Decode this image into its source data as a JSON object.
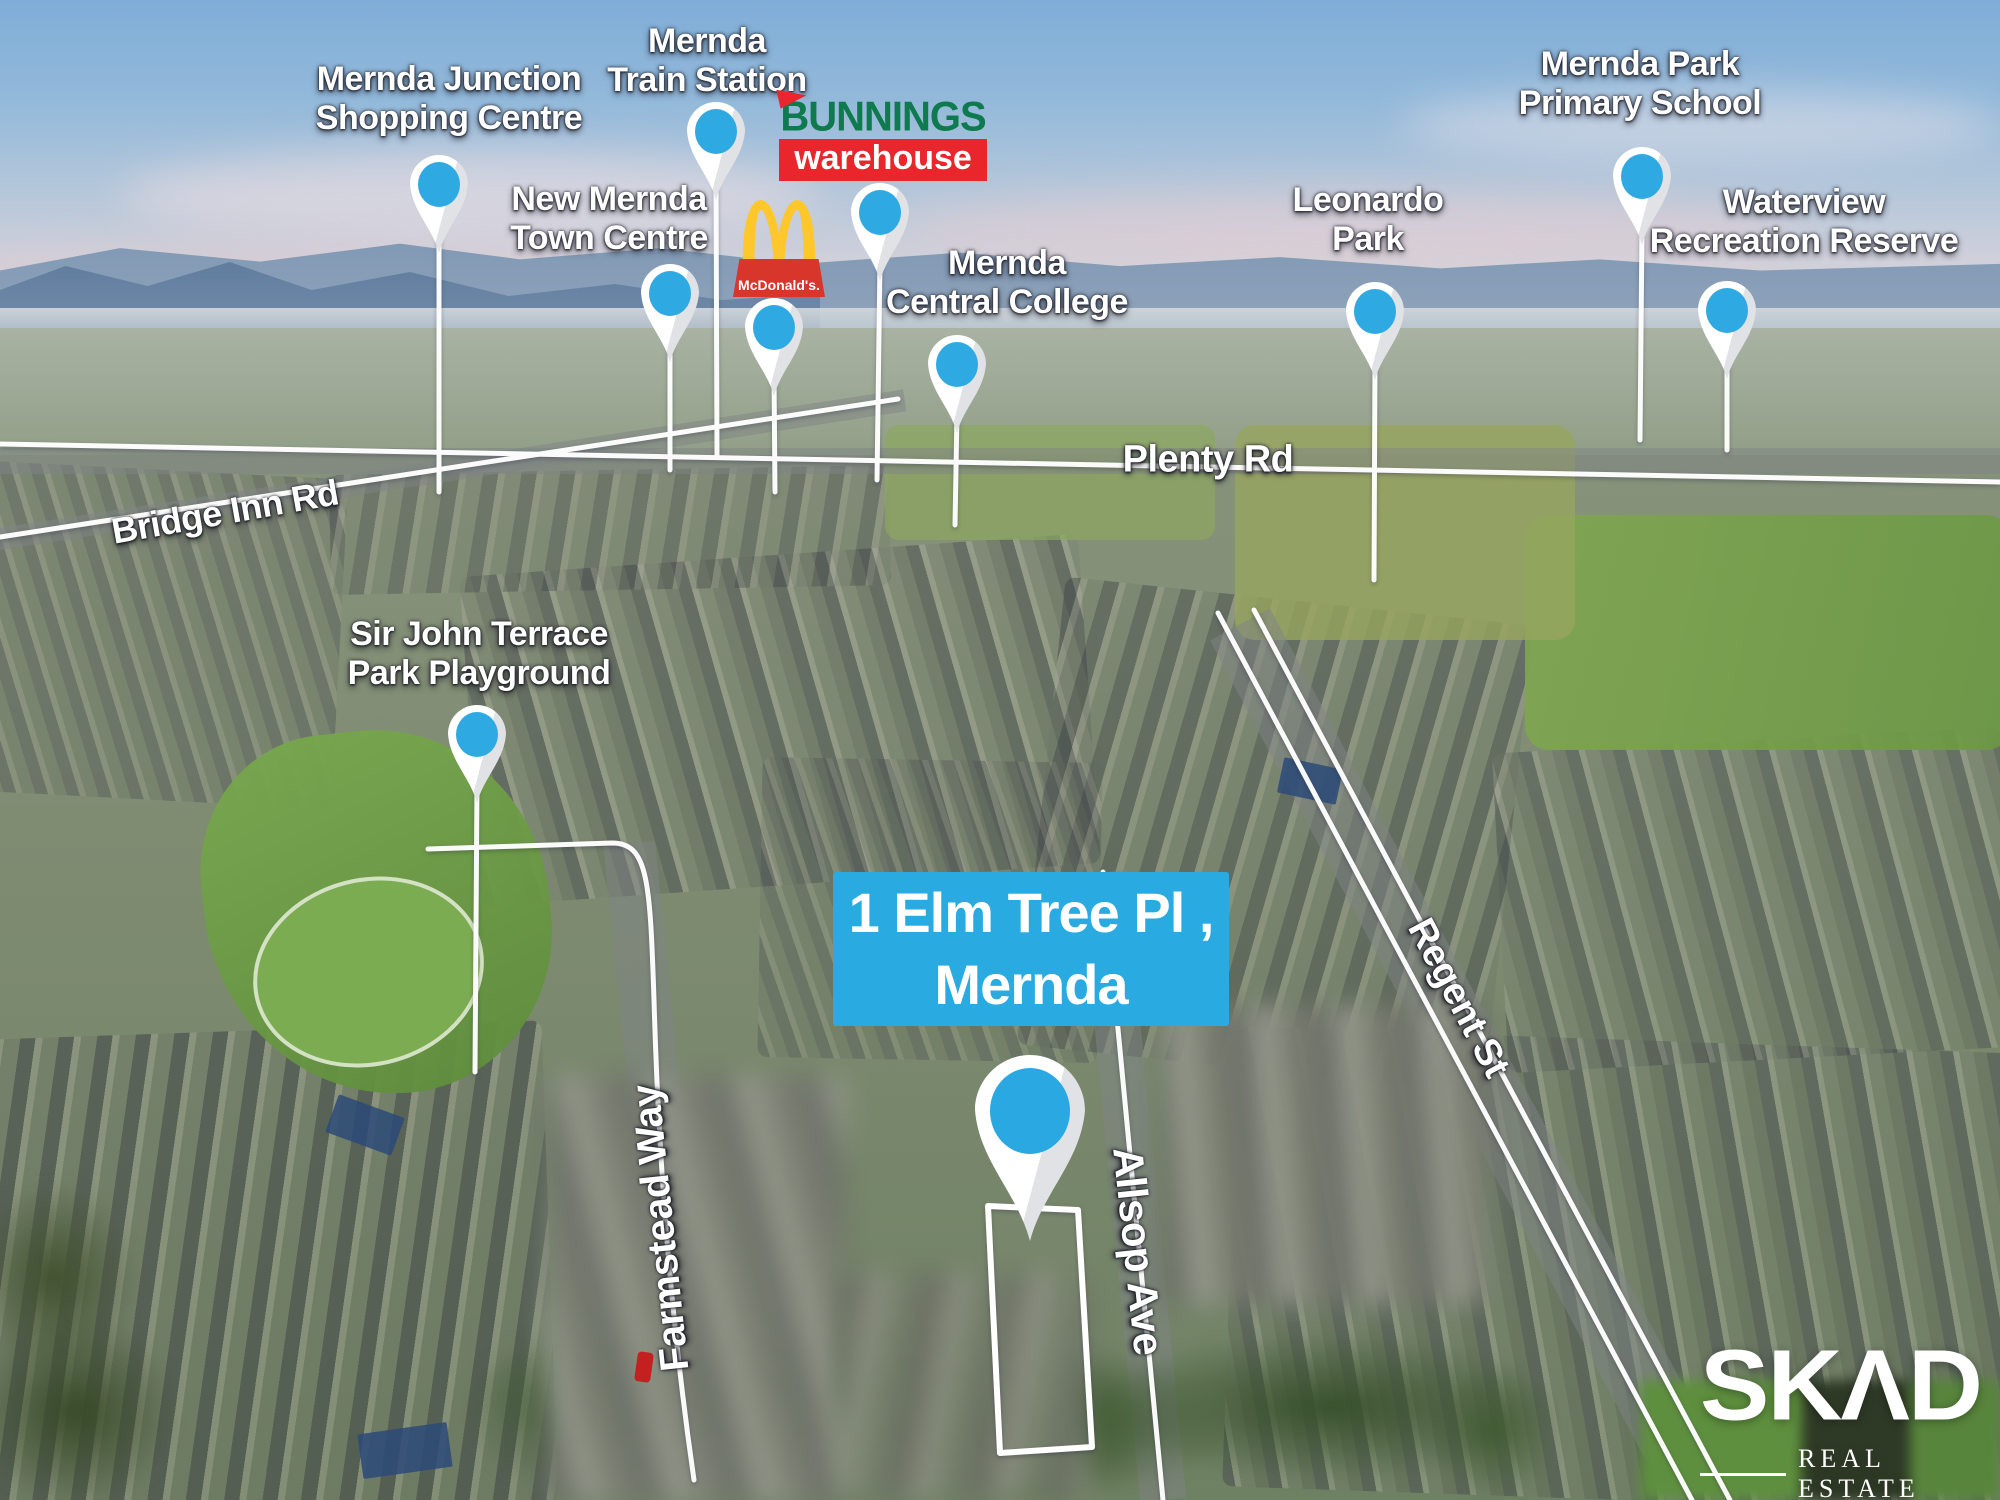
{
  "meta": {
    "type": "aerial-location-flyer",
    "suburb": "Mernda"
  },
  "address_overlay": {
    "line1": "1 Elm Tree Pl ,",
    "line2": "Mernda",
    "bg_color": "#29ABE2"
  },
  "landmarks": [
    {
      "id": "mernda-junction-shopping-centre",
      "line1": "Mernda Junction",
      "line2": "Shopping Centre"
    },
    {
      "id": "mernda-train-station",
      "line1": "Mernda",
      "line2": "Train Station"
    },
    {
      "id": "new-mernda-town-centre",
      "line1": "New Mernda",
      "line2": "Town Centre"
    },
    {
      "id": "mernda-central-college",
      "line1": "Mernda",
      "line2": "Central College"
    },
    {
      "id": "leonardo-park",
      "line1": "Leonardo",
      "line2": "Park"
    },
    {
      "id": "mernda-park-primary-school",
      "line1": "Mernda Park",
      "line2": "Primary School"
    },
    {
      "id": "waterview-recreation-reserve",
      "line1": "Waterview",
      "line2": "Recreation Reserve"
    },
    {
      "id": "sir-john-terrace-park-playground",
      "line1": "Sir John Terrace",
      "line2": "Park Playground"
    }
  ],
  "logos": {
    "bunnings": {
      "name": "BUNNINGS",
      "sub": "warehouse",
      "green": "#0E7A4E",
      "red": "#E8262C"
    },
    "mcdonalds": {
      "banner_text": "McDonald's.",
      "arches_color": "#FFC72C",
      "banner_color": "#D8352B"
    }
  },
  "road_labels": [
    "Bridge Inn Rd",
    "Plenty Rd",
    "Regent St",
    "Allsop Ave",
    "Farmstead Way"
  ],
  "branding": {
    "logo_text": "SKΛD",
    "tagline": "REAL ESTATE"
  },
  "colors": {
    "pin_fill": "#2FA9E2",
    "pin_body": "#FFFFFF",
    "annotation_line": "#FFFFFF"
  }
}
